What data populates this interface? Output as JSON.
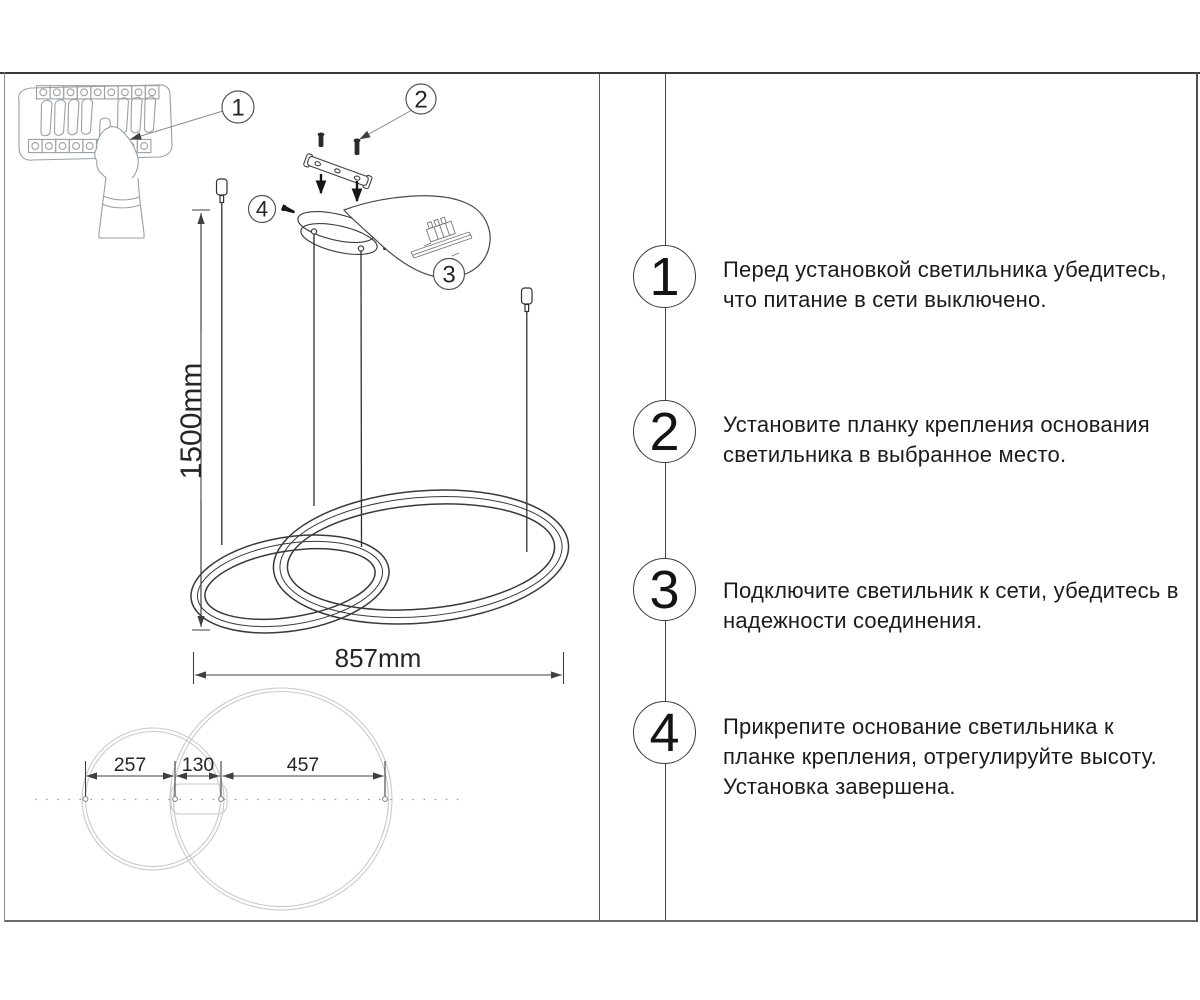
{
  "dimensions": {
    "drop_height": "1500mm",
    "overall_width": "857mm",
    "plan_left": "257",
    "plan_center": "130",
    "plan_right": "457"
  },
  "callouts": [
    {
      "label": "1"
    },
    {
      "label": "2"
    },
    {
      "label": "3"
    },
    {
      "label": "4"
    }
  ],
  "steps": [
    {
      "num": "1",
      "lines": [
        "Перед установкой светильника убедитесь,",
        "что питание в сети выключено."
      ]
    },
    {
      "num": "2",
      "lines": [
        "Установите планку крепления основания",
        "светильника в выбранное место."
      ]
    },
    {
      "num": "3",
      "lines": [
        "Подключите светильник к сети, убедитесь в",
        "надежности соединения."
      ]
    },
    {
      "num": "4",
      "lines": [
        "Прикрепите основание светильника к",
        "планке крепления, отрегулируйте высоту.",
        "Установка завершена."
      ]
    }
  ],
  "colors": {
    "ink": "#3a3a3a",
    "light_gray": "#9aa0a3",
    "plan_gray": "#c9c9c9",
    "text": "#1d1d1d",
    "background": "#ffffff"
  }
}
